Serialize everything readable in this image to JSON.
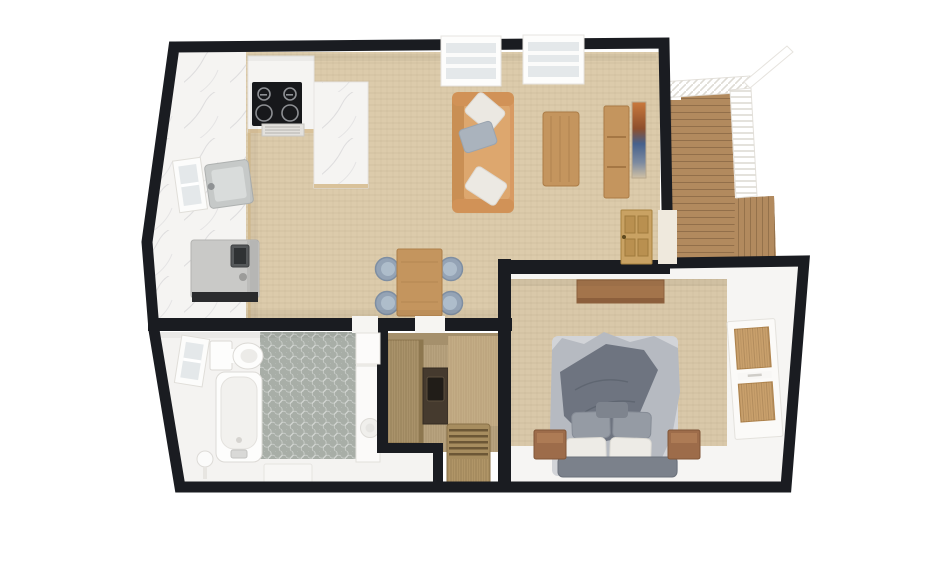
{
  "scene": {
    "type": "3d-floor-plan",
    "background": "#ffffff",
    "rooms": [
      {
        "name": "kitchen",
        "furniture": [
          "cooktop",
          "extractor-vent",
          "marble-counter",
          "marble-peninsula",
          "sink",
          "refrigerator",
          "window"
        ]
      },
      {
        "name": "living-room",
        "furniture": [
          "sofa",
          "throw-pillows",
          "coffee-table",
          "media-console",
          "wall-art",
          "balcony-door",
          "window",
          "window"
        ]
      },
      {
        "name": "dining-area",
        "furniture": [
          "dining-table",
          "chair",
          "chair",
          "chair",
          "chair"
        ]
      },
      {
        "name": "bathroom",
        "furniture": [
          "toilet",
          "bathtub",
          "vanity-sink",
          "bath-mat",
          "towel-radiator",
          "window",
          "door"
        ]
      },
      {
        "name": "laundry-closet",
        "furniture": [
          "wardrobe-cabinet",
          "appliance",
          "laundry-basket"
        ]
      },
      {
        "name": "bedroom",
        "furniture": [
          "double-bed",
          "nightstand",
          "nightstand",
          "wall-shelf",
          "fitted-wardrobe"
        ]
      },
      {
        "name": "deck",
        "furniture": [
          "decking",
          "steps",
          "railing"
        ]
      }
    ]
  },
  "colors": {
    "wall": "#1a1c21",
    "floor": "#dccbab",
    "carpet": "#d9c8a9",
    "marble": "#f5f4f2",
    "bathfloor": "#f4f3f1",
    "tile": "#a8aea7",
    "deck": "#b28a5e",
    "wood": "#c4955e",
    "sofa": "#d89a62",
    "chair": "#94a3b5",
    "door": "#c9a263",
    "duvet": "#b6bac1",
    "blanket": "#6e7480",
    "bench": "#7b818b",
    "closetwood": "#b7a27e",
    "fridge": "#c9c9c7",
    "cooktop": "#17181b",
    "white": "#fdfdfc",
    "glass": "#e4e8ea"
  }
}
